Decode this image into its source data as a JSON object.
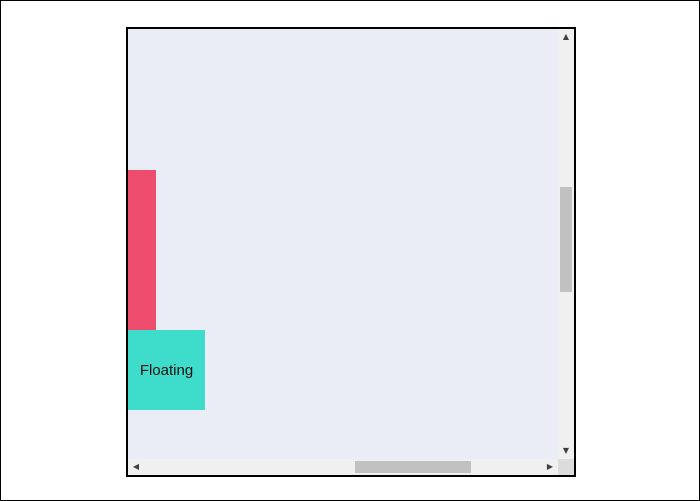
{
  "scroll_area": {
    "content": {
      "floating_box_label": "Floating"
    },
    "scrollbars": {
      "up_arrow_icon": "▲",
      "down_arrow_icon": "▼",
      "left_arrow_icon": "◀",
      "right_arrow_icon": "▶"
    },
    "colors": {
      "panel_bg": "#eaedf6",
      "pink_bar": "#ee4d6e",
      "teal_box": "#3eddcb",
      "track": "#f0f0f0",
      "thumb": "#c1c1c1",
      "corner": "#dcdcdc",
      "arrow": "#404040",
      "border": "#000000",
      "label_text": "#101010"
    }
  }
}
